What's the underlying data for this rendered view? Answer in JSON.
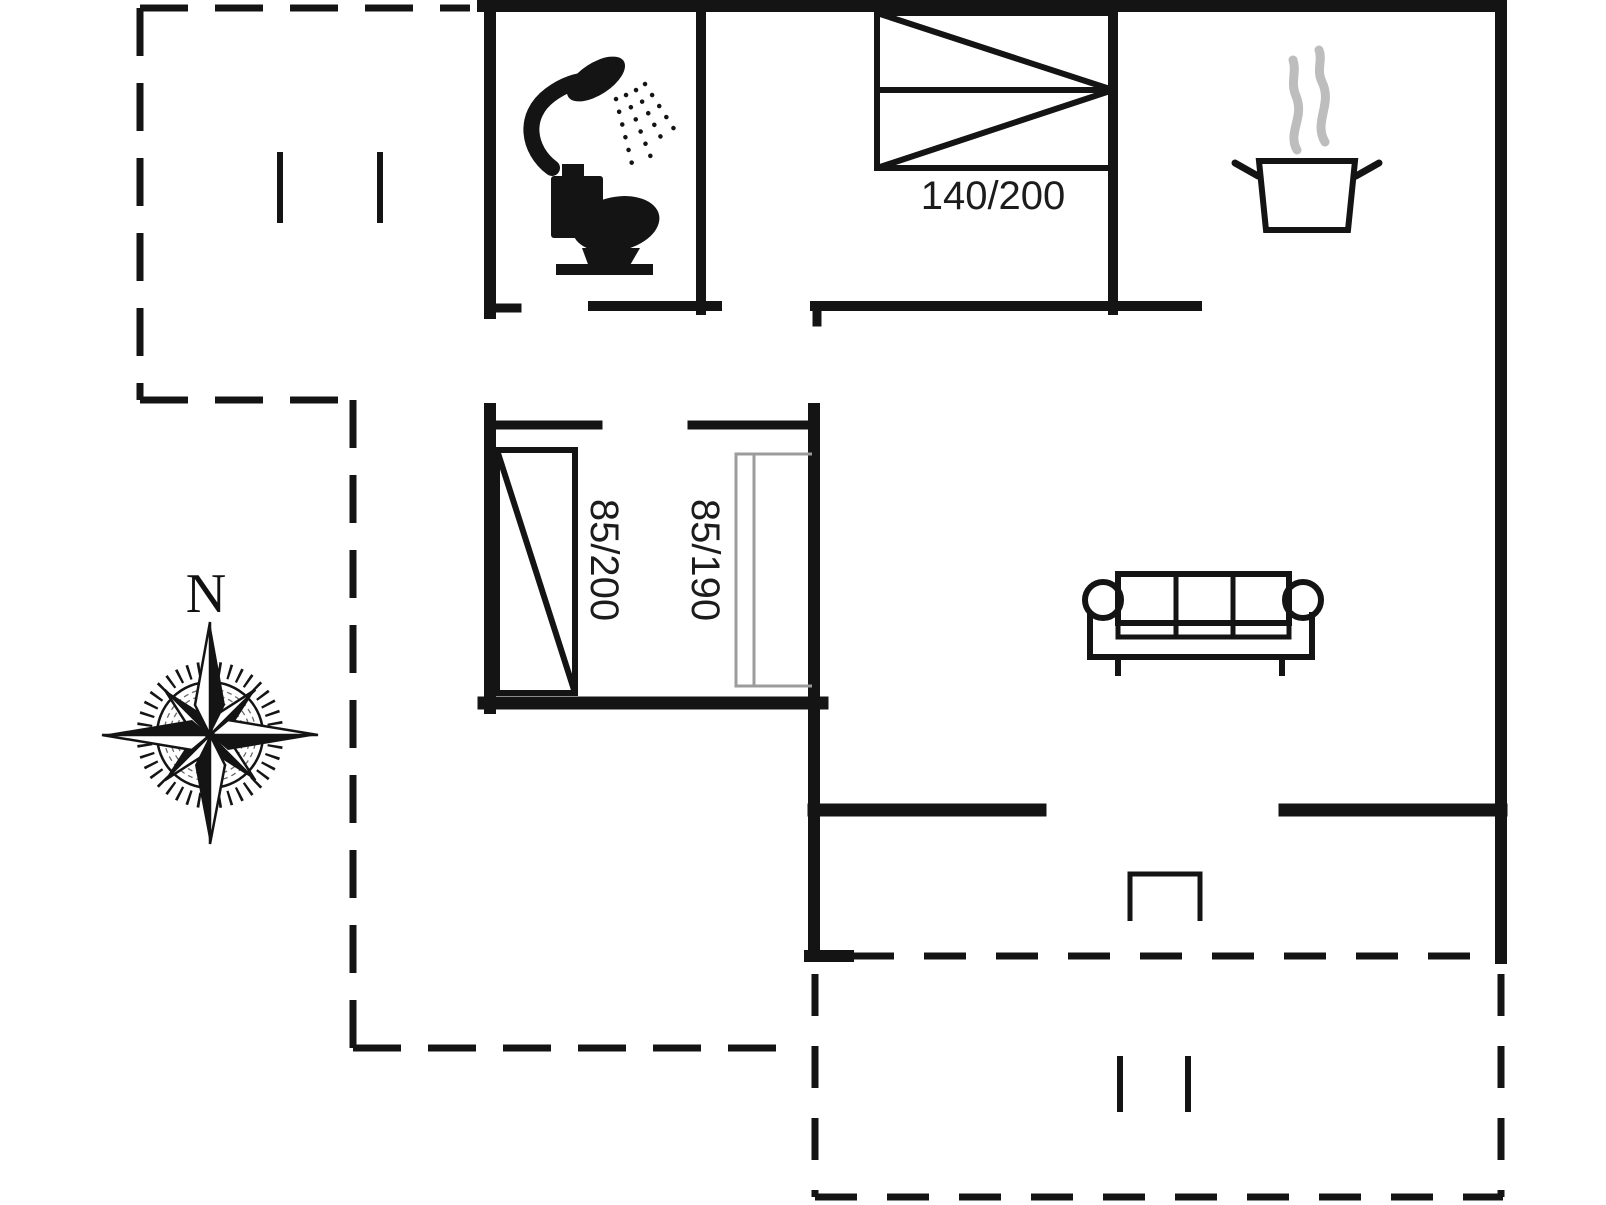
{
  "labels": {
    "double_bed_size": "140/200",
    "single_bed_left_size": "85/200",
    "single_bed_right_size": "85/190",
    "compass_north": "N"
  },
  "icons": [
    "shower-icon",
    "toilet-icon",
    "cooking-pot-icon",
    "steam-icon",
    "double-bed-symbol",
    "single-bed-symbol",
    "single-bed-symbol-gray",
    "sofa-icon",
    "compass-rose-icon",
    "doormat-symbol"
  ],
  "colors": {
    "line": "#141414",
    "bed_gray": "#9c9c9c",
    "steam_gray": "#bdbdbd",
    "texture_gray": "#6a6a6a",
    "bg": "#ffffff"
  }
}
